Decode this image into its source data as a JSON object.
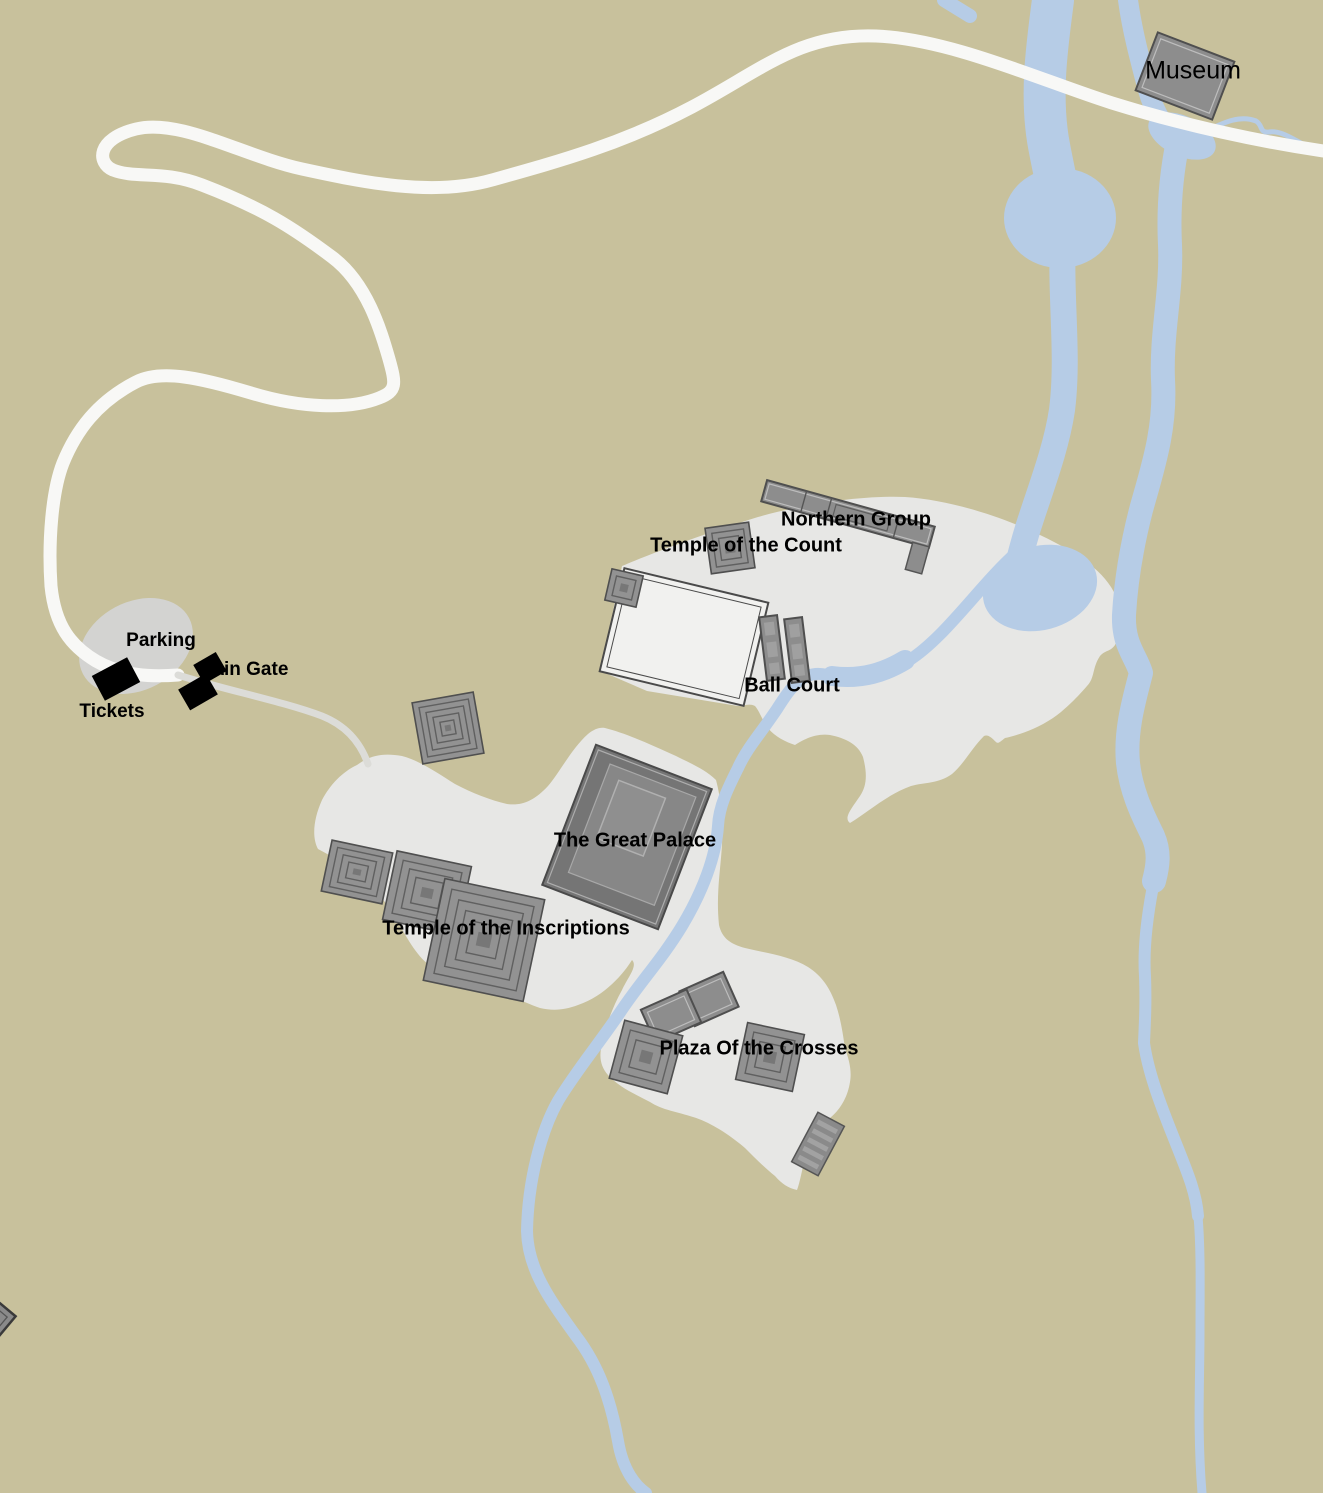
{
  "map": {
    "title": "Archaeological site map",
    "labels": {
      "museum": "Museum",
      "northern_group": "Northern Group",
      "temple_of_the_count": "Temple of the Count",
      "ball_court": "Ball Court",
      "parking": "Parking",
      "main_gate": "Main Gate",
      "tickets": "Tickets",
      "great_palace": "The Great Palace",
      "temple_of_the_inscriptions": "Temple of the Inscriptions",
      "plaza_of_the_crosses": "Plaza Of the Crosses"
    },
    "colors": {
      "background": "#c8c19c",
      "water": "#b6cce6",
      "road": "#f8f8f6",
      "trail": "#dcdcd8",
      "site_area": "#e7e7e5",
      "plaza_fill": "#f1f1ef",
      "parking_area": "#d3d3d1",
      "building": "#8d8d8d",
      "building_dark": "#757575",
      "outline": "#4f4f4f",
      "black": "#000000",
      "label": "#000000"
    }
  }
}
